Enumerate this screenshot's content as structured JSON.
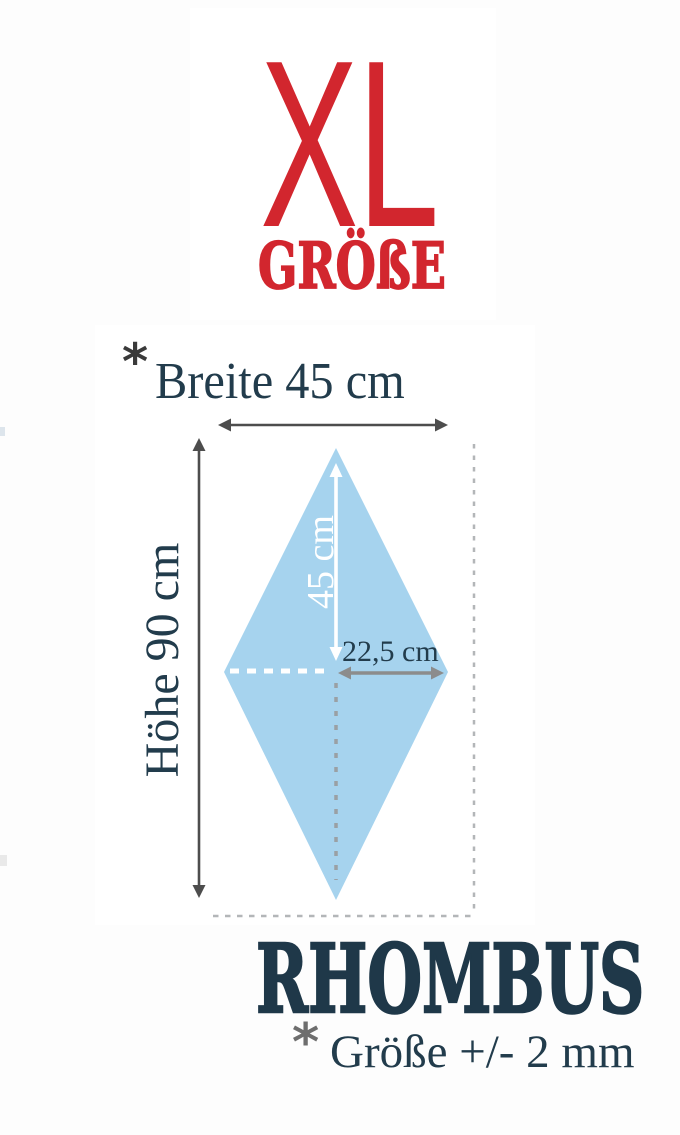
{
  "header": {
    "size_code": "XL",
    "size_word": "GRÖßE"
  },
  "measurements": {
    "width": {
      "asterisk": "*",
      "label": "Breite 45 cm"
    },
    "height": {
      "label": "Höhe 90 cm"
    },
    "half_height": {
      "label": "45 cm"
    },
    "half_width": {
      "label": "22,5 cm"
    }
  },
  "shape": {
    "name": "RHOMBUS",
    "width_cm": 45,
    "height_cm": 90,
    "half_width_cm": 22.5,
    "half_height_cm": 45
  },
  "tolerance": {
    "asterisk": "*",
    "label": "Größe +/- 2 mm"
  },
  "colors": {
    "red": "#d2262e",
    "navy": "#223c4c",
    "rhombus_navy": "#1f3849",
    "diamond_blue": "#a6d3ee",
    "arrow_dark": "#4d4d4d",
    "arrow_gray": "#8c8c8c",
    "dash_gray": "#9aa0a4",
    "dash_light": "#b3b6b8",
    "white": "#ffffff"
  }
}
